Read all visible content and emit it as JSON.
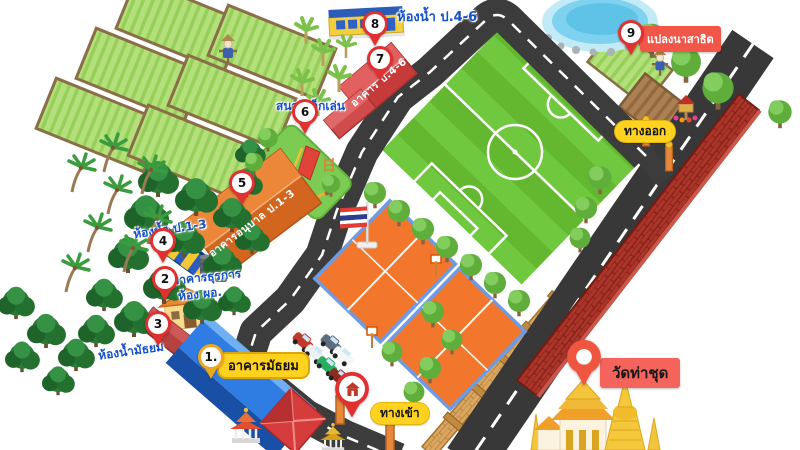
{
  "map": {
    "title": "school-campus-illustrated-map",
    "labels": {
      "toilet_p46": "ห้องน้ำ ป.4-6",
      "building_p46": "อาคาร ป.4-6",
      "playground": "สนามเด็กเล่น",
      "kindergarten_building": "อาคารอนุบาล ป.1-3",
      "toilet_p13": "ห้องน้ำ ป.1-3",
      "admin_building_line1": "อาคารธุรการ",
      "admin_building_line2": "ห้อง ผอ.",
      "toilet_secondary": "ห้องน้ำมัธยม",
      "secondary_building": "อาคารมัธยม",
      "rice_field_demo": "แปลงนาสาธิต",
      "exit": "ทางออก",
      "entrance": "ทางเข้า",
      "temple": "วัดท่าชุด"
    },
    "markers": {
      "m1": {
        "number": "1."
      },
      "m2": {
        "number": "2"
      },
      "m3": {
        "number": "3"
      },
      "m4": {
        "number": "4"
      },
      "m5": {
        "number": "5"
      },
      "m6": {
        "number": "6"
      },
      "m7": {
        "number": "7"
      },
      "m8": {
        "number": "8"
      },
      "m9": {
        "number": "9"
      }
    },
    "colors": {
      "marker_red": "#e03030",
      "marker_gold": "#eda61d",
      "label_blue": "#1450c8",
      "pill_yellow": "#ffd21f",
      "tag_red": "#f25648",
      "temple_tag": "#f4645c",
      "road": "#3c3c3c",
      "field_green": "#63b82f",
      "court_orange": "#f2772c",
      "brick_wall": "#ac352a",
      "tan_wall": "#d9a75f"
    }
  }
}
